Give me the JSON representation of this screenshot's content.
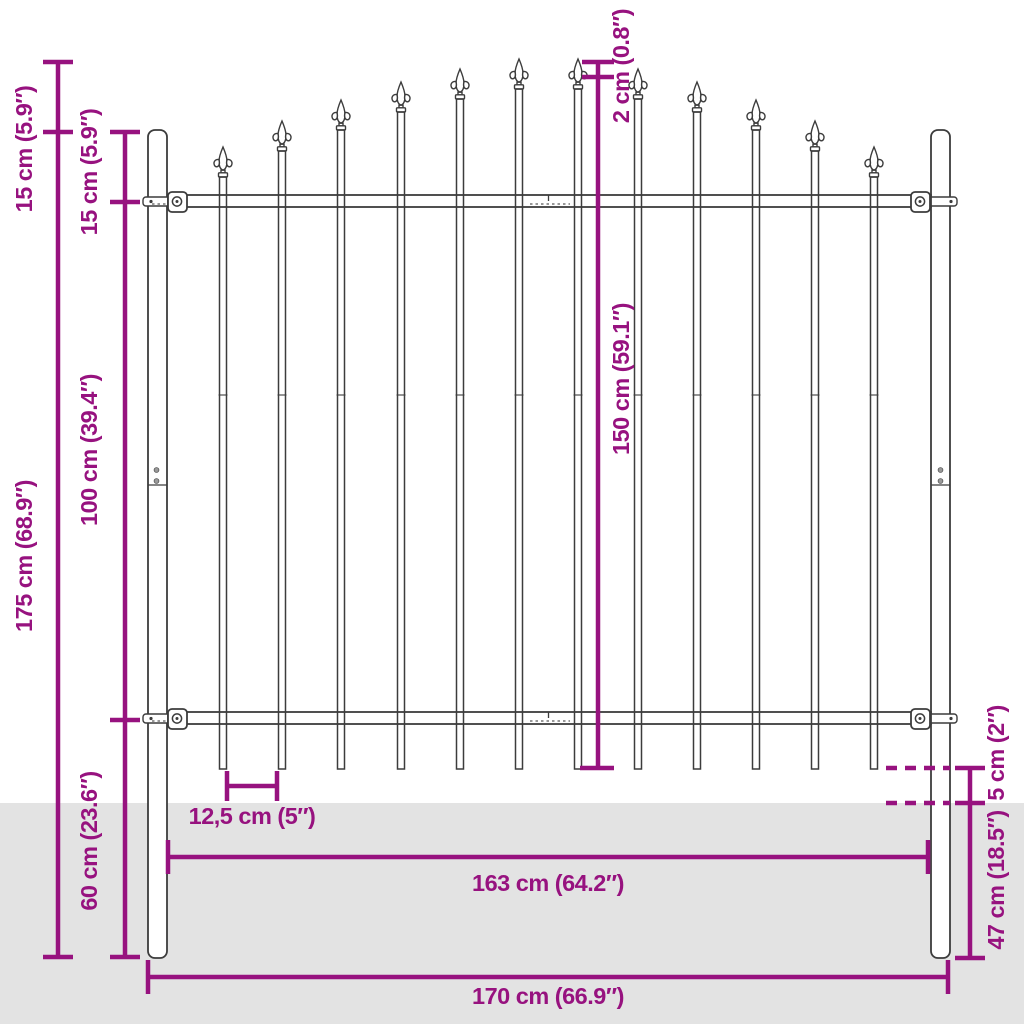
{
  "diagram": {
    "description": "Dimension diagram of a steel fence panel with arched spear-topped bars, two round posts, two horizontal rails and ground level indication"
  },
  "colors": {
    "dimension_lines": "#97127F",
    "label_text": "#97127F",
    "fence_outline": "#3C3C3C",
    "ground": "#E3E3E3",
    "background": "#FFFFFF"
  },
  "labels": {
    "spear_tip_to_post_top": "15 cm (5.9″)",
    "post_top_to_top_rail": "15 cm (5.9″)",
    "total_height": "175 cm (68.9″)",
    "rail_to_rail": "100 cm (39.4″)",
    "lower_section_height": "60 cm (23.6″)",
    "spear_step": "2 cm (0.8″)",
    "bar_height": "150 cm (59.1″)",
    "bar_spacing": "12,5 cm (5″)",
    "rail_width": "163 cm (64.2″)",
    "total_width": "170 cm (66.9″)",
    "bar_to_ground": "5 cm (2″)",
    "post_in_ground": "47 cm (18.5″)"
  }
}
